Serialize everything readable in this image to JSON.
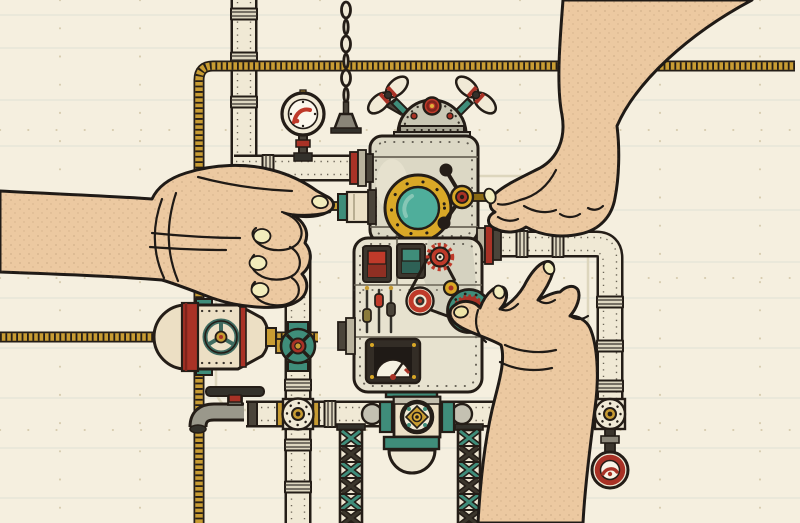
{
  "scene": {
    "description": "Vintage line-art illustration of a riveted steampunk boiler machine connected to a network of pipes; three human hands operate it: a left fist pushing a plunger rod, a top-right hand turning a crank valve, and a bottom-right hand placing a teal gear wheel.",
    "background_color": "#f5efdf",
    "palette": {
      "outline": "#241d17",
      "pipe_cream": "#f0e9d5",
      "pipe_band": "#ddd6c0",
      "striped_pipe_gold": "#c89c33",
      "machine_body": "#e7e2cf",
      "machine_dome": "#c9c6b4",
      "teal": "#3f8d7a",
      "red": "#bf3a2a",
      "dark_red": "#8f2f23",
      "gold": "#d9a827",
      "dark_metal": "#4a443a",
      "skin": "#ecc9a1",
      "nail": "#f2ecbc",
      "paper_rule": "#ccd6cd"
    },
    "elements": [
      {
        "name": "paper-background",
        "desc": "cream blueprint paper with faint ruled lines and rivet dots"
      },
      {
        "name": "striped-pipe",
        "desc": "thin gold hatched conduit running along top edge, down left side and across to the tank"
      },
      {
        "name": "cream-pipes",
        "desc": "thick riveted cream pipes with coupling bands linking machine, junctions and floor line"
      },
      {
        "name": "pressure-gauge",
        "desc": "round dial gauge on a stalk above the upper feed pipe"
      },
      {
        "name": "pull-chain",
        "desc": "hanging chain with trapezoid pull handle"
      },
      {
        "name": "torpedo-tank",
        "desc": "capsule tank with red bands and teal tri-spoke emblem at pipe crossing"
      },
      {
        "name": "inline-valve",
        "desc": "teal and red valve on the vertical pipe left of the machine"
      },
      {
        "name": "faucet",
        "desc": "grey spigot with dark hand-wheel at lower left"
      },
      {
        "name": "cross-junction",
        "desc": "bolted flange cross fitting on the bottom pipe run"
      },
      {
        "name": "tee-junction",
        "desc": "bolted flange tee fitting at lower right"
      },
      {
        "name": "hanging-gauge",
        "desc": "red-ringed clock gauge hanging below the tee"
      },
      {
        "name": "truss-towers",
        "desc": "two lattice support towers with teal and dark X bracing"
      },
      {
        "name": "boiler-machine",
        "desc": "central riveted machine with dome, wing-nut propellers, porthole, crank, switches, sliders, belt drive and meter"
      },
      {
        "name": "porthole",
        "desc": "gold bolted ring with teal glass"
      },
      {
        "name": "crank-valve",
        "desc": "spoked crank with black ball handles being turned by the top-right hand"
      },
      {
        "name": "teal-gear-wheel",
        "desc": "teal bolted wheel with red gear ring pinched by the bottom-right hand"
      },
      {
        "name": "plunger",
        "desc": "gold rod and teal-capped cylinder pushed by the left fist"
      },
      {
        "name": "hand-left",
        "desc": "fist entering from left pressing the plunger rod"
      },
      {
        "name": "hand-top-right",
        "desc": "hand reaching from top right turning the crank pin"
      },
      {
        "name": "hand-bottom-right",
        "desc": "hand reaching from bottom right holding the gear wheel"
      }
    ]
  }
}
